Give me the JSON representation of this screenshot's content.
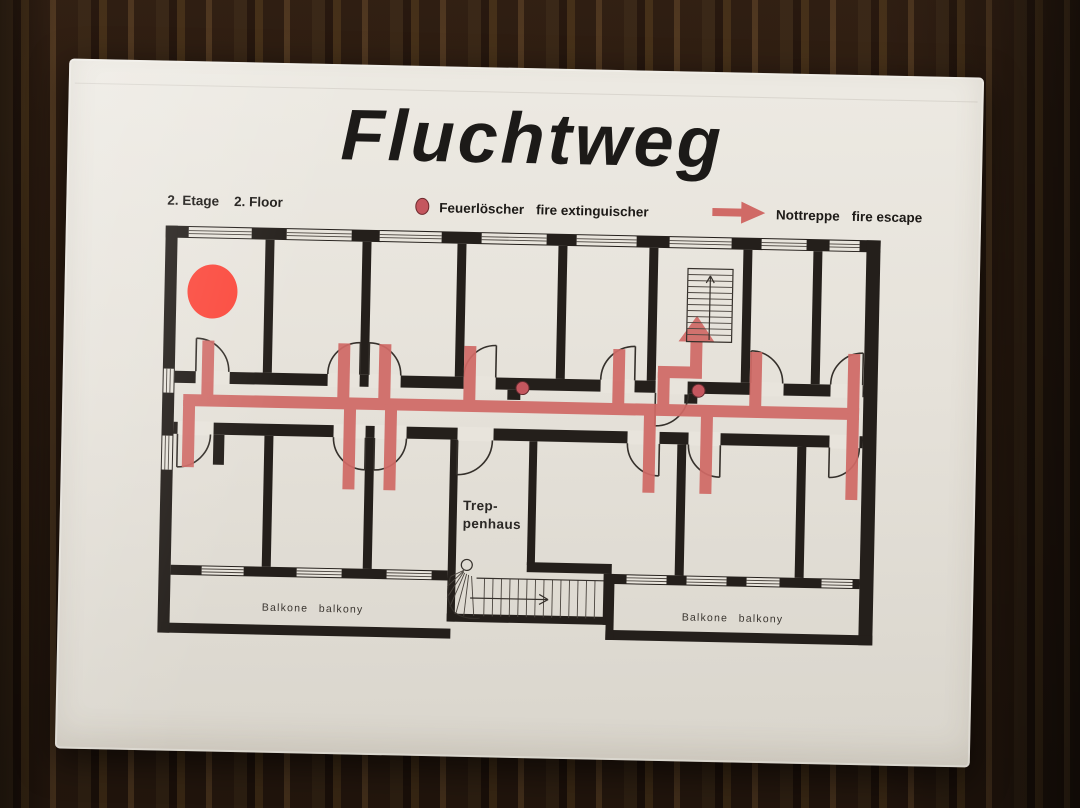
{
  "sign": {
    "title": "Fluchtweg",
    "floor": {
      "de": "2. Etage",
      "en": "2. Floor"
    },
    "legend": {
      "extinguisher": {
        "de": "Feuerlöscher",
        "en": "fire extinguischer"
      },
      "escape": {
        "de": "Nottreppe",
        "en": "fire escape"
      }
    },
    "plan": {
      "stairwell": {
        "line1": "Trep-",
        "line2": "penhaus"
      },
      "balcony_left": {
        "de": "Balkone",
        "en": "balkony"
      },
      "balcony_right": {
        "de": "Balkone",
        "en": "balkony"
      }
    },
    "colors": {
      "route_red": "#d06a66",
      "extinguisher_red": "#fb4a3e",
      "wall_black": "#241f1b",
      "paper": "#e6e2da"
    }
  }
}
